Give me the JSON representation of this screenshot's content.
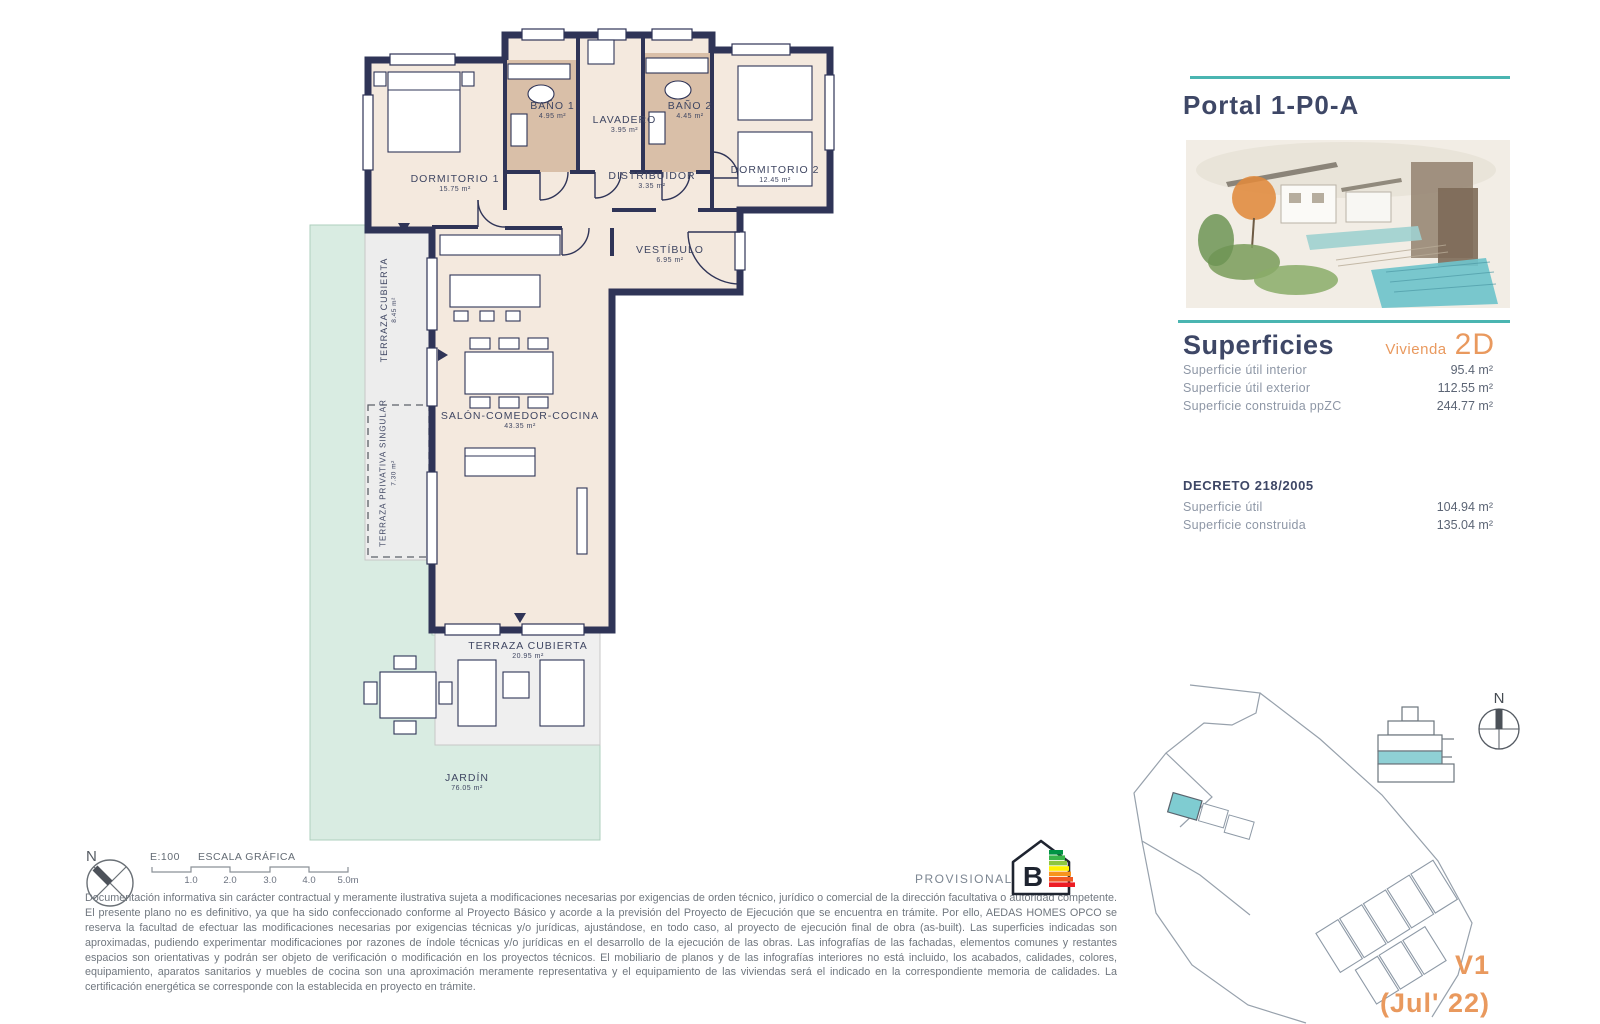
{
  "panel": {
    "title": "Portal 1-P0-A",
    "superficies": {
      "heading": "Superficies",
      "vivienda_label": "Vivienda",
      "vivienda_code": "2D",
      "rows": [
        {
          "label": "Superficie útil interior",
          "value": "95.4 m²"
        },
        {
          "label": "Superficie útil exterior",
          "value": "112.55 m²"
        },
        {
          "label": "Superficie construida ppZC",
          "value": "244.77 m²"
        }
      ]
    },
    "decreto": {
      "heading": "DECRETO 218/2005",
      "rows": [
        {
          "label": "Superficie útil",
          "value": "104.94 m²"
        },
        {
          "label": "Superficie construida",
          "value": "135.04 m²"
        }
      ]
    },
    "version": "V1",
    "version_date": "(Jul' 22)"
  },
  "floor_plan": {
    "rooms": [
      {
        "name": "DORMITORIO 1",
        "area": "15.75 m²"
      },
      {
        "name": "BAÑO 1",
        "area": "4.95 m²"
      },
      {
        "name": "LAVADERO",
        "area": "3.95 m²"
      },
      {
        "name": "BAÑO 2",
        "area": "4.45 m²"
      },
      {
        "name": "DORMITORIO 2",
        "area": "12.45 m²"
      },
      {
        "name": "DISTRIBUIDOR",
        "area": "3.35 m²"
      },
      {
        "name": "VESTÍBULO",
        "area": "6.95 m²"
      },
      {
        "name": "SALÓN-COMEDOR-COCINA",
        "area": "43.35 m²"
      },
      {
        "name": "TERRAZA CUBIERTA",
        "area": "8.45 m²"
      },
      {
        "name": "TERRAZA PRIVATIVA SINGULAR",
        "area": "7.30 m²"
      },
      {
        "name": "TERRAZA CUBIERTA",
        "area": "20.95 m²"
      },
      {
        "name": "JARDÍN",
        "area": "76.05 m²"
      }
    ]
  },
  "scale": {
    "ratio": "E:100",
    "label": "ESCALA GRÁFICA",
    "ticks": [
      "1.0",
      "2.0",
      "3.0",
      "4.0",
      "5.0m"
    ]
  },
  "compass": {
    "north": "N"
  },
  "energy": {
    "label": "PROVISIONAL",
    "rating": "B"
  },
  "disclaimer": "Documentación informativa sin carácter contractual y meramente ilustrativa sujeta a modificaciones necesarias por exigencias de orden técnico, jurídico o comercial de la dirección facultativa o autoridad competente. El presente plano no es definitivo, ya que ha sido confeccionado conforme al Proyecto Básico y acorde a la previsión del Proyecto de Ejecución que se encuentra en trámite. Por ello, AEDAS HOMES OPCO se reserva la facultad de efectuar las modificaciones necesarias por exigencias técnicas y/o jurídicas, ajustándose, en todo caso, al proyecto de ejecución final de obra (as-built). Las superficies indicadas son aproximadas, pudiendo experimentar modificaciones por razones de índole técnicas y/o jurídicas en el desarrollo de la ejecución de las obras. Las infografías de las fachadas, elementos comunes y restantes espacios son orientativas y podrán ser objeto de verificación o modificación en los proyectos técnicos. El mobiliario de planos y de las infografías interiores no está incluido, los acabados, calidades, colores, equipamiento, aparatos sanitarios y muebles de cocina son una aproximación meramente representativa y el equipamiento de las viviendas será el indicado en la correspondiente memoria de calidades. La certificación energética se corresponde con la establecida en proyecto en trámite.",
  "colors": {
    "teal": "#4ab5b1",
    "orange": "#e9995e",
    "navy": "#3e4766",
    "wall": "#2f3457",
    "room_fill": "#f4e9de",
    "bath_fill": "#d9bfa8",
    "garden": "#d9ece2",
    "terrace": "#ededed"
  }
}
